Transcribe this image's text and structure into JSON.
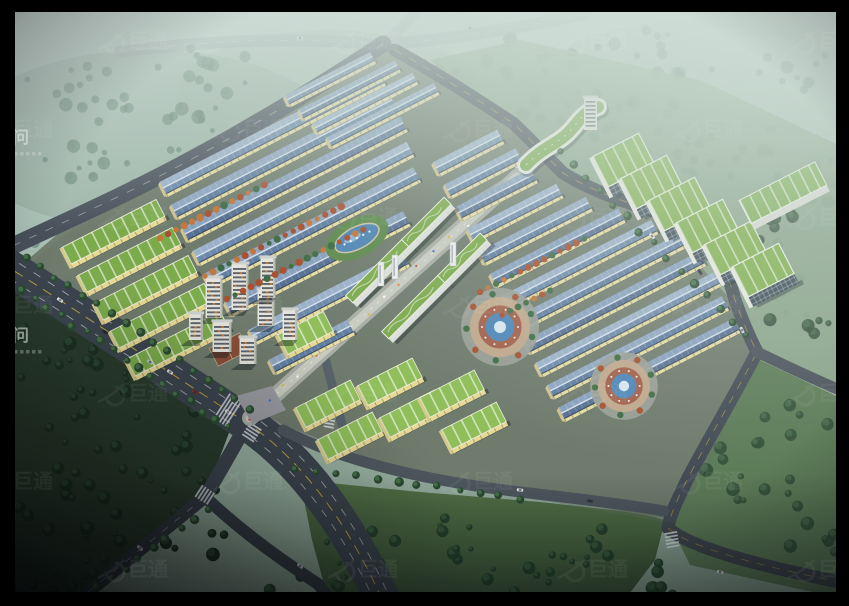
{
  "watermarks": {
    "left_text": "顾问",
    "tiled_logo_text": "巨通",
    "left_baselines_y": [
      143,
      341
    ],
    "tile_grid": {
      "x0": 128,
      "col_step": 230,
      "y0": 48,
      "row_step": 88,
      "odd_row_offset": 115,
      "opacity": 0.05
    }
  },
  "palette": {
    "mist_top": "#c6d8d0",
    "mist_mid": "#a3bcb0",
    "mist_low": "#8ea797",
    "asphalt": "#3c454f",
    "asphalt_light": "#97a1a6",
    "apron": "#73806f",
    "apron_dark": "#67736a",
    "roof_blue_light_a": "#9bb1c9",
    "roof_blue_dark_a": "#6c89ab",
    "roof_blue_light_b": "#8fa6c0",
    "roof_blue_dark_b": "#5f7da1",
    "roof_blue_light_c": "#87a0bd",
    "roof_blue_dark_c": "#566f93",
    "ridge": "#e8eef3",
    "wall_yellow": "#e6dca4",
    "wall_end": "#cfc28e",
    "roof_green": "#7cab4c",
    "roof_green_bright": "#8fbe5a",
    "glass_front": "#3b4a55",
    "white_frame": "#eef0e8",
    "lawn_bright": "#5d8a4d",
    "lawn_south": "#4e6b46",
    "lawn_right": "#5d7c58",
    "forest_base": "#2a3d2e",
    "tree_dark": "#1d3023",
    "tree_mid": "#2c4a33",
    "tree_light": "#49774c",
    "tree_red": "#a8502f",
    "tree_orange": "#c4763b",
    "tree_mist": "#67857a",
    "pond_blue": "#4f86b4",
    "plaza_tan": "#c0a88c",
    "plaza_red": "#a2604a",
    "pool_blue": "#4e86b8",
    "tower_face": "#e4e4dc",
    "tower_band": "#474e57",
    "tower_accent": "#c97b3b",
    "mall_base": "#a9aea6",
    "mall_inner": "#c8cbc0",
    "lane_yellow": "#d4b23e",
    "lane_white": "#e8ecee"
  },
  "scene": {
    "border": {
      "top": 12,
      "bottom": 14,
      "left": 15,
      "right": 13
    },
    "ne_road_polyline": [
      [
        383,
        44
      ],
      [
        430,
        70
      ],
      [
        460,
        93
      ],
      [
        513,
        123
      ],
      [
        533,
        157
      ],
      [
        563,
        173
      ],
      [
        620,
        197
      ],
      [
        683,
        220
      ],
      [
        710,
        245
      ],
      [
        735,
        300
      ],
      [
        757,
        352
      ]
    ],
    "park_apron": "18,268 60,232 287,96 340,62 395,48 432,64 545,158 650,210 740,310 757,352 700,470 672,520 560,500 420,478 283,425",
    "roads": {
      "highway_a": "M 120,52 C 240,36 320,40 383,44 C 450,40 520,28 585,14",
      "highway_b": "M 428,-4 C 412,18 398,33 383,44",
      "west_road": "M 383,44 C 330,80 250,128 190,160 C 120,198 50,228 0,252",
      "boulevard": "M 0,262 C 80,312 180,380 247,423 C 300,458 350,525 385,606",
      "south_arm": "M 247,423 C 230,455 215,480 205,497",
      "branch_dl": "M 205,497 L 77,601",
      "branch_link": "M 203,495 C 245,535 285,562 318,584 L 335,606",
      "east_road": "M 395,50 C 440,75 470,95 513,123 C 524,133 540,150 563,173 C 600,196 650,210 683,220 C 710,232 725,262 735,300 C 745,328 752,342 757,352 C 735,395 705,445 688,478 C 678,498 670,515 668,528",
      "east_bend": "M 668,528 C 690,548 760,566 849,584",
      "east_branch_r": "M 757,352 C 790,368 820,382 849,394",
      "south_road": "M 283,430 C 340,460 420,480 520,492 C 590,500 630,505 664,511",
      "inner_street": "M 318,330 L 342,425",
      "axis_street": "M 465,208 L 517,177"
    },
    "sheds_nw": [
      [
        163,
        188,
        245
      ],
      [
        174,
        211,
        245
      ],
      [
        185,
        234,
        245
      ],
      [
        196,
        257,
        240
      ],
      [
        207,
        280,
        235
      ],
      [
        228,
        308,
        200
      ],
      [
        252,
        336,
        172
      ],
      [
        272,
        366,
        88
      ]
    ],
    "sheds_top": {
      "origins": [
        [
          287,
          100
        ],
        [
          301,
          114
        ],
        [
          315,
          128
        ],
        [
          329,
          142
        ]
      ],
      "max_len": 132,
      "w": 10,
      "margin": 12
    },
    "sheds_right": {
      "x0": 436,
      "y0": 168,
      "dx": 11.4,
      "dy": 22.3,
      "n": 12,
      "max_len": 215,
      "w": 13,
      "margin": 16
    },
    "shed_w_nw": 14,
    "green_zone_a": {
      "origins": [
        [
          66,
          256
        ],
        [
          82,
          284
        ],
        [
          98,
          312
        ],
        [
          114,
          340
        ],
        [
          130,
          368
        ]
      ],
      "len": 106,
      "w": 19
    },
    "green_zone_f": {
      "origins": [
        [
          300,
          418
        ],
        [
          322,
          450
        ],
        [
          362,
          396
        ],
        [
          384,
          428
        ],
        [
          424,
          408
        ],
        [
          446,
          440
        ]
      ],
      "len": 62,
      "w": 22
    },
    "zone_g": {
      "x0": 600,
      "y0": 172,
      "dx": 28,
      "dy": 22,
      "n": 6,
      "len": 52,
      "w": 34,
      "slab": [
        745,
        212,
        85,
        26
      ]
    },
    "wave_building": {
      "path": "M 528,168 C 545,150 558,148 570,136 C 580,126 584,116 600,110",
      "tower": [
        584,
        130,
        13,
        32
      ]
    },
    "axis": {
      "a": [
        250,
        418
      ],
      "b": [
        517,
        177
      ],
      "slabs": [
        [
          352,
          302,
          80
        ],
        [
          408,
          246,
          60
        ],
        [
          388,
          338,
          80
        ],
        [
          444,
          282,
          60
        ]
      ],
      "pylons": [
        [
          378,
          262
        ],
        [
          392,
          255
        ],
        [
          450,
          242
        ]
      ],
      "pond": [
        357,
        238
      ]
    },
    "apartments": {
      "towers": [
        [
          214,
          318,
          17,
          40
        ],
        [
          240,
          310,
          17,
          46
        ],
        [
          266,
          326,
          17,
          36
        ],
        [
          290,
          340,
          15,
          30
        ],
        [
          222,
          352,
          19,
          30
        ],
        [
          248,
          364,
          17,
          26
        ],
        [
          196,
          340,
          14,
          26
        ],
        [
          268,
          298,
          15,
          40
        ]
      ],
      "podium": [
        282,
        345,
        52,
        22
      ],
      "court": [
        228,
        350
      ],
      "plaza": "236,396 272,386 286,410 252,424"
    },
    "plazas": [
      [
        500,
        327,
        30
      ],
      [
        624,
        386,
        26
      ]
    ],
    "zebras": [
      [
        228,
        410,
        33,
        30
      ],
      [
        252,
        432,
        -57,
        14
      ],
      [
        205,
        495,
        33,
        14
      ],
      [
        672,
        540,
        80,
        13
      ],
      [
        330,
        420,
        -80,
        10
      ],
      [
        517,
        162,
        40,
        12
      ]
    ],
    "cars": [
      [
        60,
        300,
        33,
        "#e8e8e8"
      ],
      [
        105,
        332,
        33,
        "#2b313a"
      ],
      [
        150,
        362,
        33,
        "#c0c4c8"
      ],
      [
        195,
        392,
        33,
        "#8a2f2a"
      ],
      [
        228,
        412,
        33,
        "#e8e8e8"
      ],
      [
        300,
        38,
        -3,
        "#dfe3e6"
      ],
      [
        470,
        28,
        -8,
        "#b8bfc6"
      ],
      [
        652,
        236,
        45,
        "#e6e6e6"
      ],
      [
        700,
        272,
        55,
        "#343a42"
      ],
      [
        742,
        330,
        65,
        "#d9dde0"
      ],
      [
        520,
        490,
        6,
        "#e2e2e2"
      ],
      [
        590,
        501,
        6,
        "#3a4047"
      ],
      [
        140,
        548,
        40,
        "#d6d9dc"
      ],
      [
        300,
        566,
        38,
        "#c9ced2"
      ],
      [
        720,
        572,
        10,
        "#e6e6e6"
      ],
      [
        170,
        372,
        33,
        "#e0e0e0"
      ]
    ],
    "mist_clusters": [
      [
        80,
        90,
        70,
        26,
        14
      ],
      [
        220,
        70,
        80,
        24,
        12
      ],
      [
        360,
        100,
        60,
        20,
        10
      ],
      [
        120,
        160,
        90,
        28,
        14
      ],
      [
        300,
        170,
        70,
        22,
        10
      ],
      [
        40,
        230,
        50,
        18,
        8
      ],
      [
        520,
        60,
        80,
        22,
        10
      ],
      [
        650,
        90,
        90,
        26,
        12
      ],
      [
        780,
        70,
        70,
        24,
        10
      ],
      [
        700,
        140,
        80,
        24,
        10
      ],
      [
        810,
        160,
        60,
        20,
        8
      ],
      [
        630,
        40,
        60,
        18,
        8
      ],
      [
        160,
        120,
        70,
        22,
        10
      ],
      [
        260,
        220,
        50,
        16,
        8
      ]
    ],
    "ne_band_clusters": [
      [
        480,
        80,
        50,
        18,
        7
      ],
      [
        560,
        110,
        45,
        16,
        6
      ],
      [
        620,
        140,
        50,
        18,
        7
      ],
      [
        700,
        180,
        45,
        18,
        6
      ],
      [
        760,
        260,
        40,
        20,
        6
      ],
      [
        810,
        300,
        40,
        22,
        6
      ],
      [
        840,
        200,
        30,
        20,
        5
      ]
    ],
    "forest_clusters": [
      [
        40,
        340,
        60,
        40,
        12
      ],
      [
        120,
        420,
        80,
        50,
        16
      ],
      [
        60,
        500,
        70,
        45,
        14
      ],
      [
        150,
        540,
        80,
        40,
        14
      ],
      [
        40,
        580,
        60,
        30,
        10
      ],
      [
        190,
        480,
        50,
        35,
        10
      ],
      [
        100,
        360,
        50,
        30,
        9
      ]
    ],
    "south_lawn_clusters": [
      [
        360,
        555,
        50,
        25,
        9
      ],
      [
        440,
        540,
        45,
        22,
        8
      ],
      [
        520,
        570,
        55,
        25,
        9
      ],
      [
        300,
        585,
        40,
        18,
        6
      ],
      [
        590,
        545,
        40,
        20,
        7
      ],
      [
        650,
        582,
        45,
        20,
        7
      ]
    ],
    "right_lawn_clusters": [
      [
        790,
        430,
        40,
        25,
        7
      ],
      [
        760,
        500,
        45,
        28,
        8
      ],
      [
        820,
        540,
        35,
        20,
        6
      ],
      [
        720,
        460,
        30,
        20,
        5
      ],
      [
        800,
        330,
        35,
        20,
        6
      ],
      [
        770,
        230,
        35,
        22,
        6
      ],
      [
        680,
        420,
        25,
        18,
        5
      ]
    ],
    "red_strips": [
      [
        205,
        276,
        160
      ],
      [
        227,
        299,
        160
      ],
      [
        160,
        238,
        120
      ],
      [
        480,
        292,
        120
      ],
      [
        502,
        315,
        60
      ]
    ],
    "tree_lines": [
      [
        8,
        282,
        230,
        428,
        15
      ],
      [
        28,
        258,
        250,
        408,
        16
      ],
      [
        560,
        152,
        748,
        336,
        18
      ],
      [
        208,
        508,
        84,
        598,
        16
      ],
      [
        296,
        468,
        520,
        498,
        20
      ]
    ],
    "south_lawn": "300,480 420,492 540,502 640,513 665,520 655,560 620,606 330,606 312,540",
    "right_lawn": "760,360 849,402 849,600 690,565 668,520 688,480 735,395",
    "ne_lawn": "430,60 545,158 650,210 740,310 760,355 849,398 849,150 700,80 520,40",
    "forest": "0,280 230,430 205,497 77,600 0,606",
    "blvd_lawn": "24,272 243,416 236,426 14,284"
  }
}
